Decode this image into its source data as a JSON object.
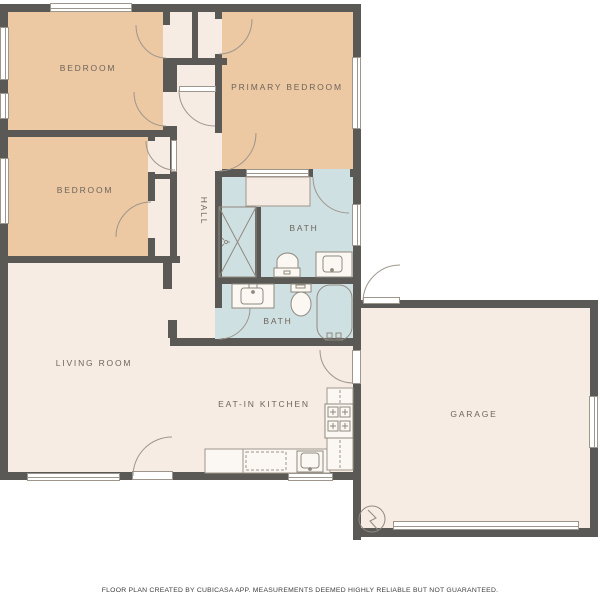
{
  "title": "Floor plan",
  "rooms": {
    "bedroom_top_left": "BEDROOM",
    "primary_bedroom": "PRIMARY BEDROOM",
    "bedroom_middle": "BEDROOM",
    "hall": "HALL",
    "bath_upper": "BATH",
    "bath_lower": "BATH",
    "living_room": "LIVING ROOM",
    "eat_in_kitchen": "EAT-IN KITCHEN",
    "garage": "GARAGE"
  },
  "footer": "FLOOR PLAN CREATED BY CUBICASA APP. MEASUREMENTS DEEMED HIGHLY RELIABLE BUT NOT GUARANTEED.",
  "colors": {
    "wall": "#5a5955",
    "bedroom_fill": "#ecc8a3",
    "bath_fill": "#cfe0e2",
    "floor_fill": "#f6ece3",
    "thin_line": "#9d968c",
    "label_text": "#6e655b",
    "background": "#ffffff"
  },
  "icons": {
    "fixtures": [
      "shower-icon",
      "toilet-icon",
      "sink-vanity-icon",
      "bathtub-icon",
      "stove-icon",
      "kitchen-sink-icon",
      "dishwasher-icon",
      "water-heater-icon",
      "door-swing-arc",
      "window",
      "garage-door"
    ]
  }
}
